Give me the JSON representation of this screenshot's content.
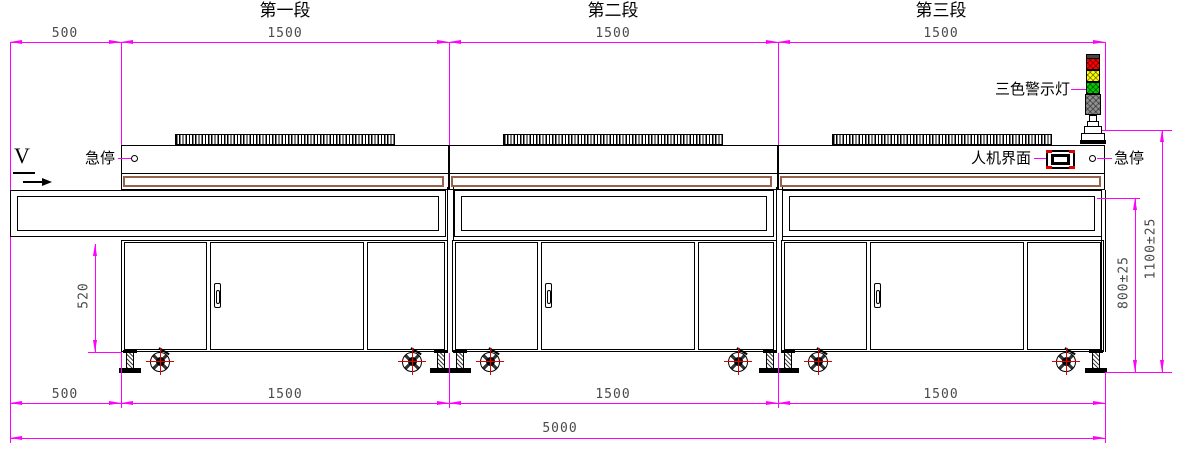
{
  "drawing": {
    "segments": [
      {
        "label": "第一段",
        "length": "1500"
      },
      {
        "label": "第二段",
        "length": "1500"
      },
      {
        "label": "第三段",
        "length": "1500"
      }
    ],
    "dimensions": {
      "top": [
        "500",
        "1500",
        "1500",
        "1500"
      ],
      "bottom": [
        "500",
        "1500",
        "1500",
        "1500"
      ],
      "overall_length": "5000",
      "cabinet_height": "520",
      "belt_height": "800±25",
      "overall_height": "1100±25"
    },
    "labels": {
      "estop_left": "急停",
      "estop_right": "急停",
      "hmi": "人机界面",
      "tower_light": "三色警示灯",
      "direction": "V"
    },
    "colors": {
      "dimension_line": "#ff00ff",
      "window_trim": "#96614d",
      "light_red": "#ff0000",
      "light_yellow": "#ffff00",
      "light_green": "#00cc00",
      "light_body": "#8f8f8f"
    }
  }
}
